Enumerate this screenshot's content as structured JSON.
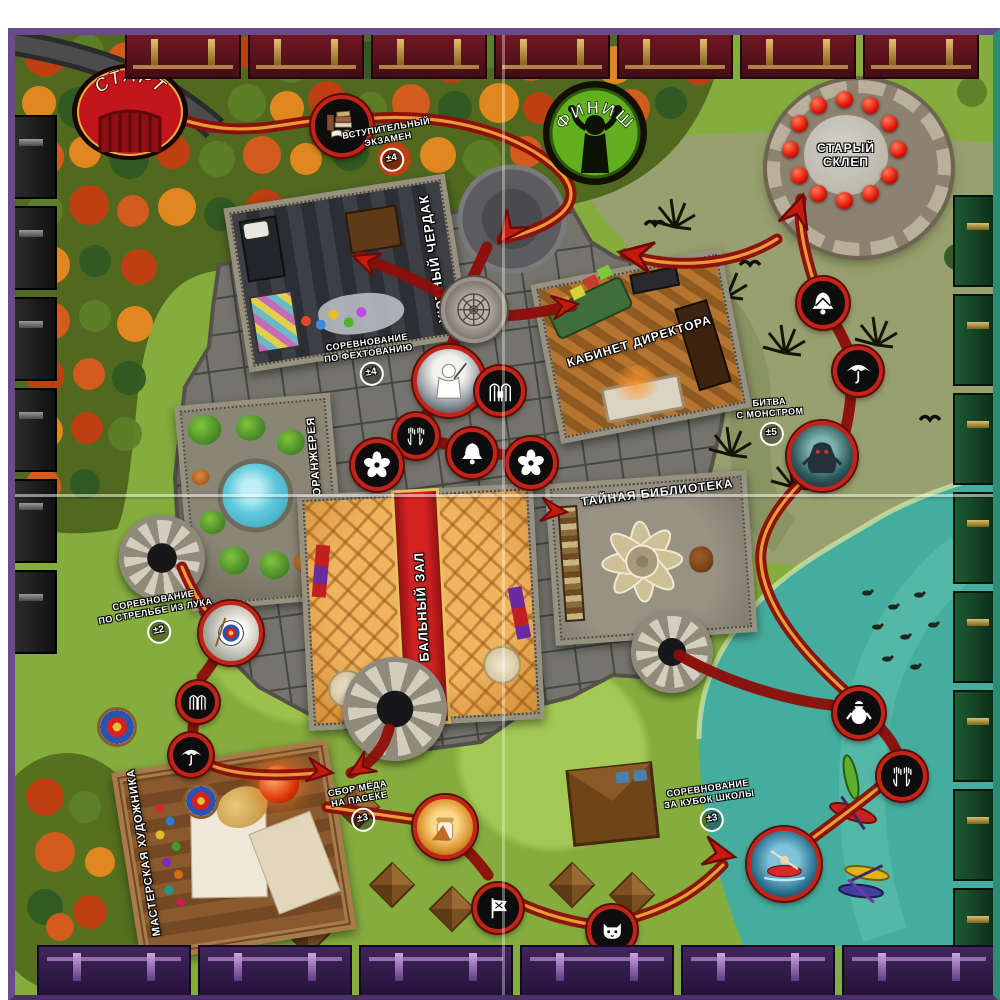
{
  "board": {
    "start_label": "СТАРТ",
    "finish_label": "ФИНИШ",
    "crypt": {
      "line1": "СТАРЫЙ",
      "line2": "СКЛЕП"
    },
    "rooms": {
      "attic": "УЮТНЫЙ ЧЕРДАК",
      "directors_office": "КАБИНЕТ ДИРЕКТОРА",
      "greenhouse": "ЦВЕТОЧНАЯ ОРАНЖЕРЕЯ",
      "ballroom": "БАЛЬНЫЙ ЗАЛ",
      "library": "ТАЙНАЯ БИБЛИОТЕКА",
      "workshop": "МАСТЕРСКАЯ ХУДОЖНИКА"
    },
    "events": {
      "entrance_exam": {
        "line1": "ВСТУПИТЕЛЬНЫЙ",
        "line2": "ЭКЗАМЕН",
        "value": "±4"
      },
      "fencing": {
        "line1": "СОРЕВНОВАНИЕ",
        "line2": "ПО ФЕХТОВАНИЮ",
        "value": "±4"
      },
      "archery": {
        "line1": "СОРЕВНОВАНИЕ",
        "line2": "ПО СТРЕЛЬБЕ ИЗ ЛУКА",
        "value": "±2"
      },
      "honey": {
        "line1": "СБОР МЁДА",
        "line2": "НА ПАСЕКЕ",
        "value": "±3"
      },
      "school_cup": {
        "line1": "СОРЕВНОВАНИЕ",
        "line2": "ЗА КУБОК ШКОЛЫ",
        "value": "±3"
      },
      "monster": {
        "line1": "БИТВА",
        "line2": "С МОНСТРОМ",
        "value": "±5"
      }
    },
    "space_icons": [
      "books-icon",
      "rosette-ornament",
      "fencer-photo",
      "gates-icon",
      "hands-icon",
      "bell-icon",
      "flower-icon",
      "umbrella-icon",
      "monster-photo",
      "archery-target-photo",
      "honey-jar-photo",
      "flag-icon",
      "cat-icon",
      "kayak-photo",
      "penguin-icon"
    ],
    "colors": {
      "path_red": "#a8140e",
      "path_core": "#f2a93b",
      "start_red": "#c3161c",
      "finish_green": "#63b01f",
      "lake_teal": "#45ad9d",
      "meadow_green": "#84ad3e",
      "crypt_orb_red": "#e01505",
      "forest_autumn": "#d05a1c"
    }
  }
}
